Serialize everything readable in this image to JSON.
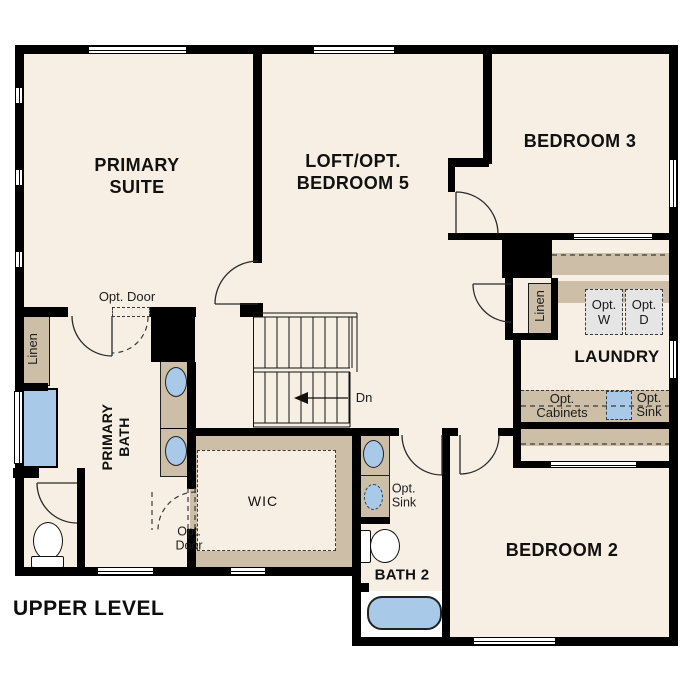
{
  "plan_title": "UPPER LEVEL",
  "colors": {
    "floor": "#f7efe3",
    "wall": "#000000",
    "cabinet_tan": "#cdbfa7",
    "fixture_blue": "#a9c9e9",
    "appliance_gray": "#e5e5e5"
  },
  "rooms": {
    "primary_suite": {
      "line1": "PRIMARY",
      "line2": "SUITE"
    },
    "loft": {
      "line1": "LOFT/OPT.",
      "line2": "BEDROOM 5"
    },
    "bedroom3": {
      "label": "BEDROOM 3"
    },
    "laundry": {
      "label": "LAUNDRY"
    },
    "primary_bath": {
      "line1": "PRIMARY",
      "line2": "BATH"
    },
    "wic": {
      "label": "WIC"
    },
    "bath2": {
      "label": "BATH 2"
    },
    "bedroom2": {
      "label": "BEDROOM 2"
    }
  },
  "features": {
    "opt_door_suite": "Opt. Door",
    "opt_door_wic": {
      "line1": "Opt.",
      "line2": "Door"
    },
    "linen_bath": "Linen",
    "linen_hall": "Linen",
    "opt_washer": {
      "line1": "Opt.",
      "line2": "W"
    },
    "opt_dryer": {
      "line1": "Opt.",
      "line2": "D"
    },
    "opt_cabinets": {
      "line1": "Opt.",
      "line2": "Cabinets"
    },
    "opt_sink_laundry": {
      "line1": "Opt.",
      "line2": "Sink"
    },
    "opt_sink_bath2": {
      "line1": "Opt.",
      "line2": "Sink"
    },
    "stairs_direction": "Dn"
  }
}
